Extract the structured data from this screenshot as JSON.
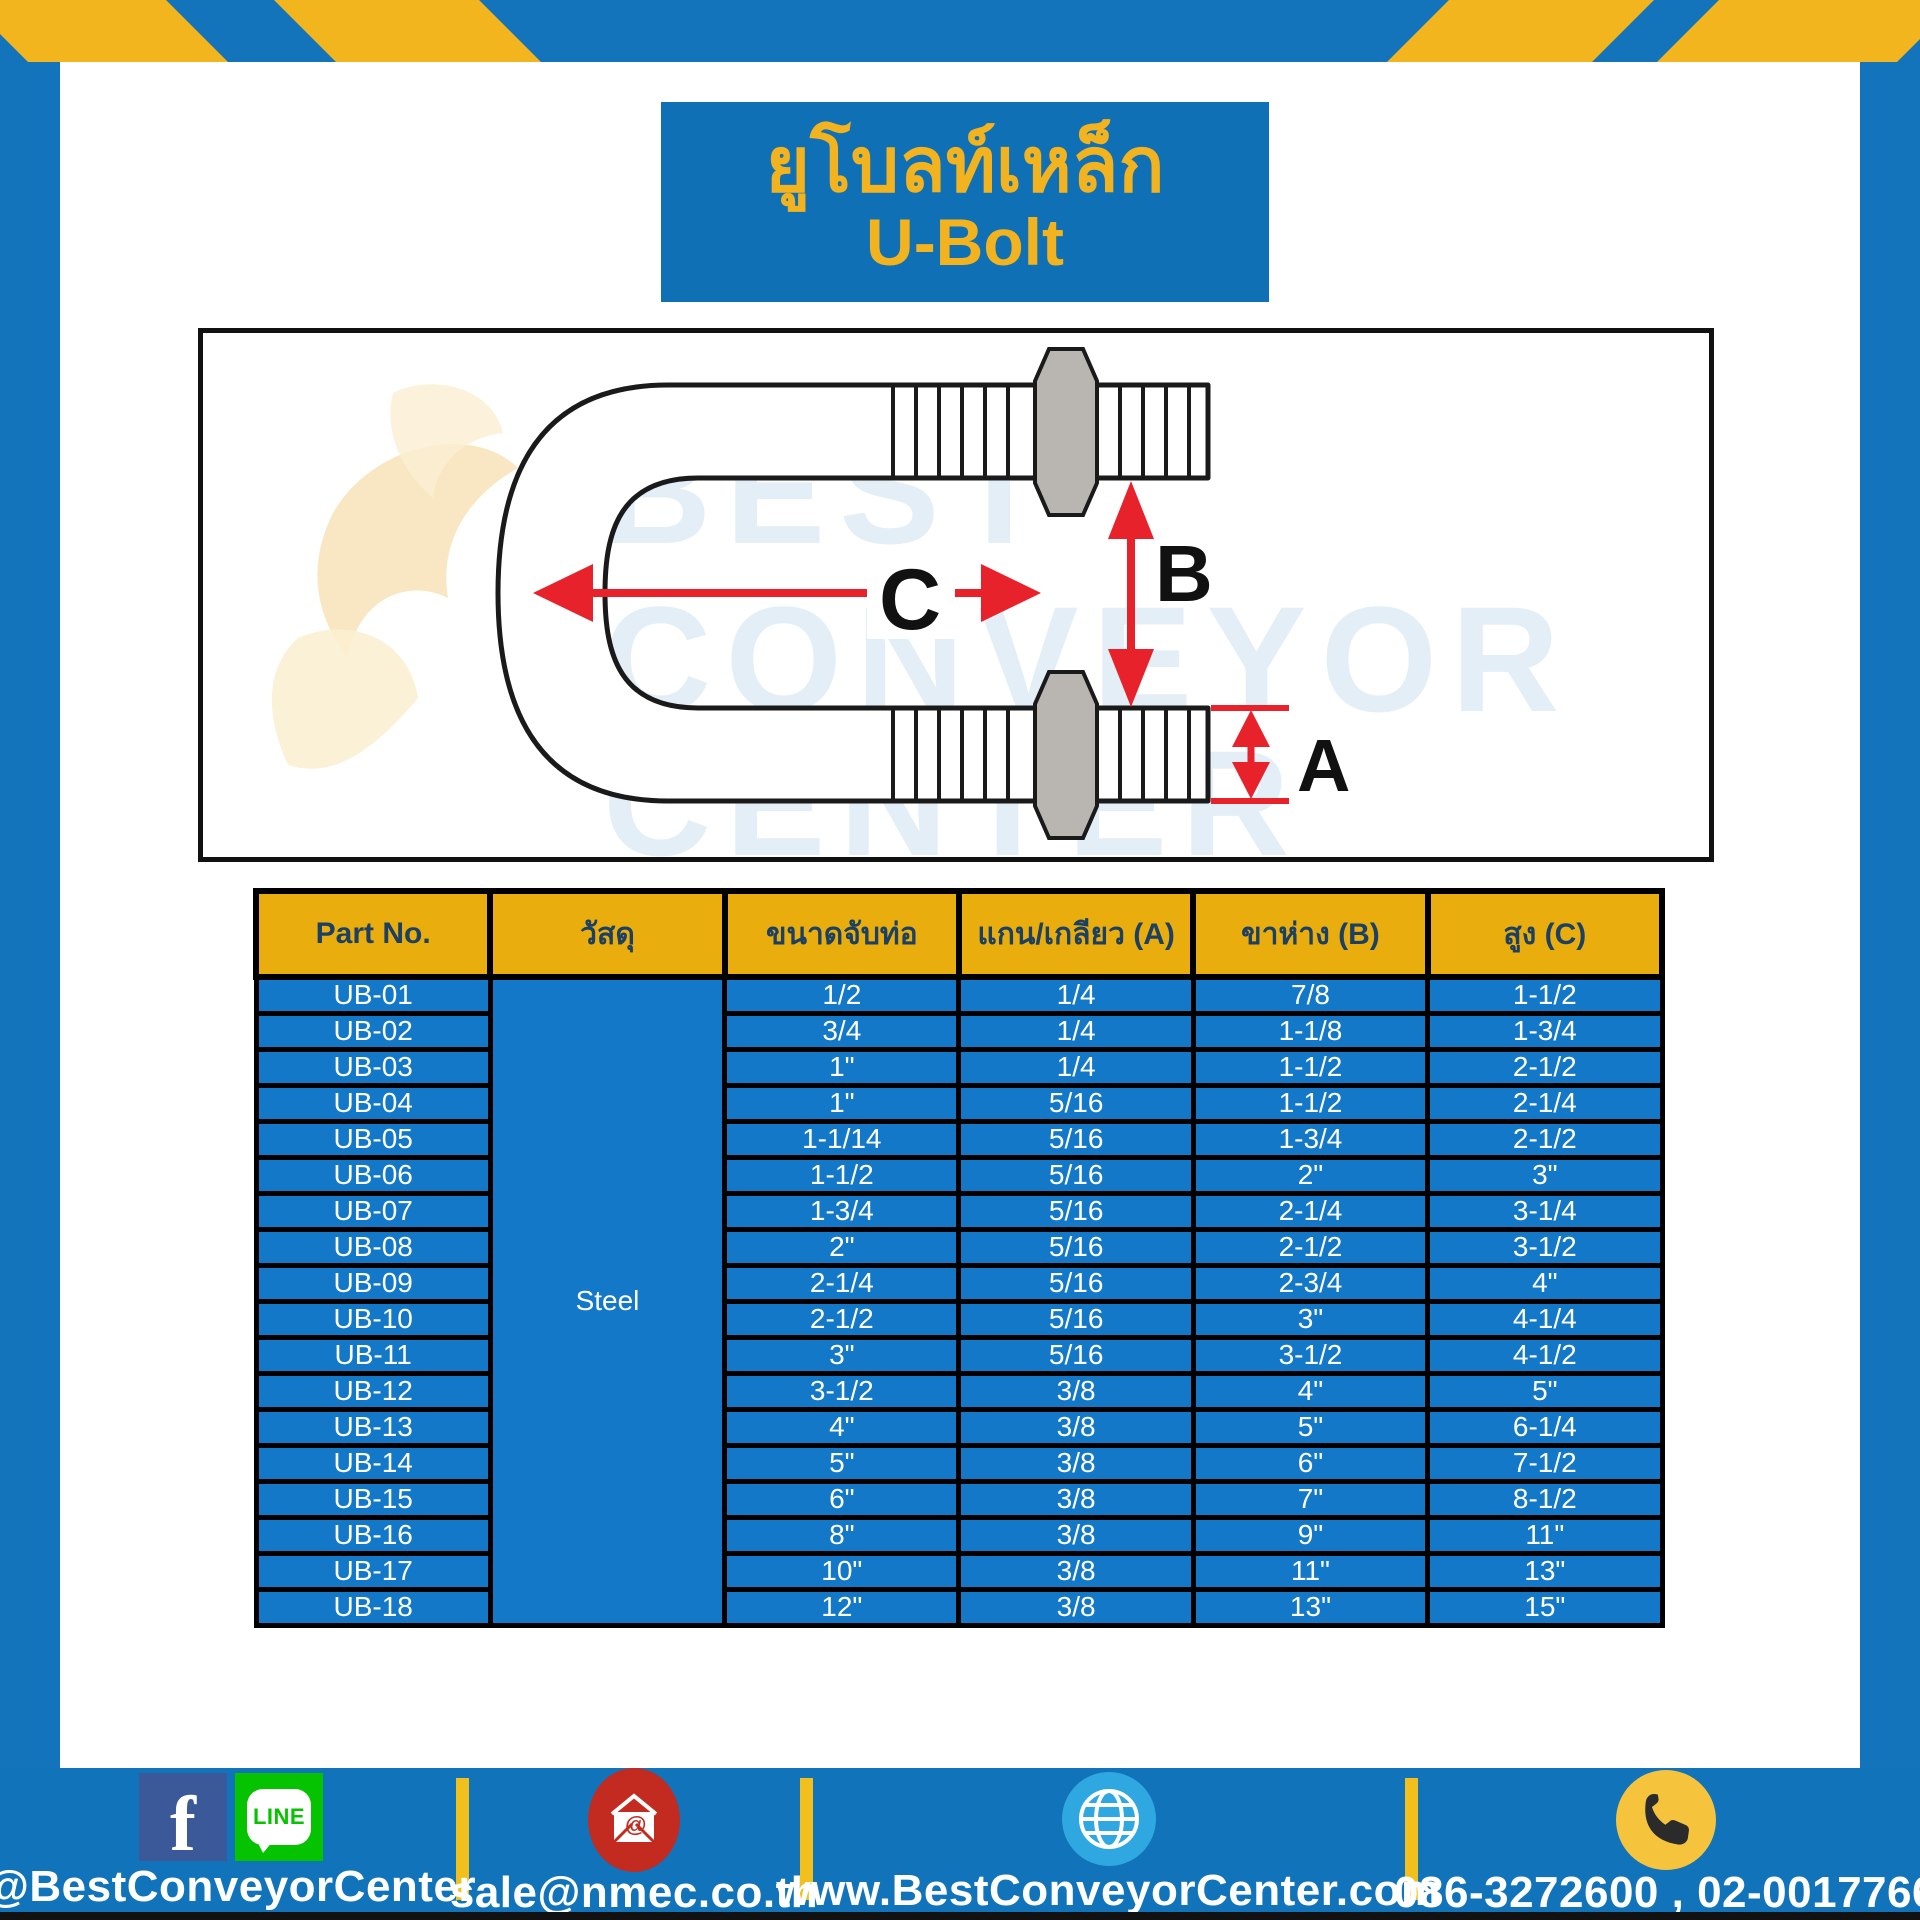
{
  "title": {
    "line_thai": "ยูโบลท์เหล็ก",
    "line_en": "U-Bolt"
  },
  "diagram": {
    "dim_a": "A",
    "dim_b": "B",
    "dim_c": "C",
    "watermark_lines": [
      "BEST",
      "CONVEYOR",
      "CENTER"
    ]
  },
  "table": {
    "headers": [
      "Part No.",
      "วัสดุ",
      "ขนาดจับท่อ",
      "แกน/เกลียว (A)",
      "ขาห่าง (B)",
      "สูง (C)"
    ],
    "material": "Steel",
    "rows": [
      {
        "part": "UB-01",
        "pipe": "1/2",
        "a": "1/4",
        "b": "7/8",
        "c": "1-1/2"
      },
      {
        "part": "UB-02",
        "pipe": "3/4",
        "a": "1/4",
        "b": "1-1/8",
        "c": "1-3/4"
      },
      {
        "part": "UB-03",
        "pipe": "1\"",
        "a": "1/4",
        "b": "1-1/2",
        "c": "2-1/2"
      },
      {
        "part": "UB-04",
        "pipe": "1\"",
        "a": "5/16",
        "b": "1-1/2",
        "c": "2-1/4"
      },
      {
        "part": "UB-05",
        "pipe": "1-1/14",
        "a": "5/16",
        "b": "1-3/4",
        "c": "2-1/2"
      },
      {
        "part": "UB-06",
        "pipe": "1-1/2",
        "a": "5/16",
        "b": "2\"",
        "c": "3\""
      },
      {
        "part": "UB-07",
        "pipe": "1-3/4",
        "a": "5/16",
        "b": "2-1/4",
        "c": "3-1/4"
      },
      {
        "part": "UB-08",
        "pipe": "2\"",
        "a": "5/16",
        "b": "2-1/2",
        "c": "3-1/2"
      },
      {
        "part": "UB-09",
        "pipe": "2-1/4",
        "a": "5/16",
        "b": "2-3/4",
        "c": "4\""
      },
      {
        "part": "UB-10",
        "pipe": "2-1/2",
        "a": "5/16",
        "b": "3\"",
        "c": "4-1/4"
      },
      {
        "part": "UB-11",
        "pipe": "3\"",
        "a": "5/16",
        "b": "3-1/2",
        "c": "4-1/2"
      },
      {
        "part": "UB-12",
        "pipe": "3-1/2",
        "a": "3/8",
        "b": "4\"",
        "c": "5\""
      },
      {
        "part": "UB-13",
        "pipe": "4\"",
        "a": "3/8",
        "b": "5\"",
        "c": "6-1/4"
      },
      {
        "part": "UB-14",
        "pipe": "5\"",
        "a": "3/8",
        "b": "6\"",
        "c": "7-1/2"
      },
      {
        "part": "UB-15",
        "pipe": "6\"",
        "a": "3/8",
        "b": "7\"",
        "c": "8-1/2"
      },
      {
        "part": "UB-16",
        "pipe": "8\"",
        "a": "3/8",
        "b": "9\"",
        "c": "11\""
      },
      {
        "part": "UB-17",
        "pipe": "10\"",
        "a": "3/8",
        "b": "11\"",
        "c": "13\""
      },
      {
        "part": "UB-18",
        "pipe": "12\"",
        "a": "3/8",
        "b": "13\"",
        "c": "15\""
      }
    ]
  },
  "footer": {
    "facebook_label": "f",
    "line_label": "LINE",
    "social_handle": "@BestConveyorCenter",
    "email": "sale@nmec.co.th",
    "website": "www.BestConveyorCenter.com",
    "phones": "086-3272600 , 02-0017766"
  },
  "colors": {
    "frame_blue": "#1374BB",
    "title_blue": "#1070B6",
    "stripe_yellow": "#F2B51E",
    "header_gold": "#E9AE0D",
    "header_text_navy": "#1C4064",
    "row_blue": "#1478C8",
    "arrow_red": "#E8222A",
    "facebook_blue": "#3B5998",
    "line_green": "#06C300",
    "email_red": "#C32B20",
    "globe_blue": "#2FA8E1",
    "phone_yellow": "#F6C43C"
  }
}
